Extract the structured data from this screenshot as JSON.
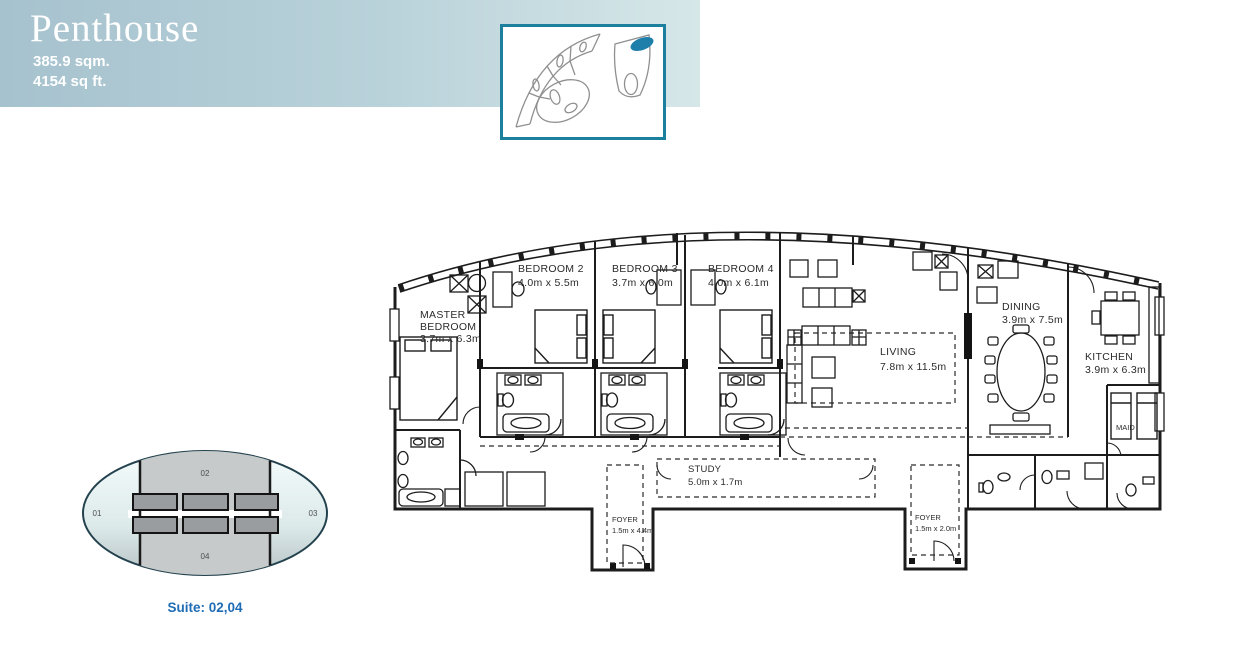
{
  "header": {
    "title": "Penthouse",
    "area_metric": "385.9 sqm.",
    "area_imperial": "4154 sq ft."
  },
  "colors": {
    "header_gradient_left": "#a6c2ce",
    "header_gradient_right": "#d6e7e8",
    "accent_teal_border": "#1d7f9e",
    "thumbnail_highlight": "#1e7fab",
    "plan_lines": "#1c1c1c",
    "keyplan_caption_blue": "#1e6cb5",
    "keyplan_band_gray": "#c6caca",
    "keyplan_rect_gray": "#9a9da0"
  },
  "floorplan": {
    "rooms": {
      "master": {
        "l1": "MASTER",
        "l2": "BEDROOM",
        "dims": "3.7m x 6.3m"
      },
      "bedroom2": {
        "name": "BEDROOM 2",
        "dims": "4.0m x 5.5m"
      },
      "bedroom3": {
        "name": "BEDROOM 3",
        "dims": "3.7m x 6.0m"
      },
      "bedroom4": {
        "name": "BEDROOM 4",
        "dims": "4.0m x 6.1m"
      },
      "living": {
        "name": "LIVING",
        "dims": "7.8m x 11.5m"
      },
      "dining": {
        "name": "DINING",
        "dims": "3.9m x 7.5m"
      },
      "kitchen": {
        "name": "KITCHEN",
        "dims": "3.9m x 6.3m"
      },
      "maid": {
        "name": "MAID"
      },
      "study": {
        "name": "STUDY",
        "dims": "5.0m x 1.7m"
      },
      "foyer_main": {
        "name": "FOYER",
        "dims": "1.5m x 4.4m"
      },
      "foyer_service": {
        "name": "FOYER",
        "dims": "1.5m x 2.0m"
      }
    }
  },
  "keyplan": {
    "suites": [
      "01",
      "02",
      "03",
      "04"
    ],
    "caption": "Suite: 02,04"
  }
}
